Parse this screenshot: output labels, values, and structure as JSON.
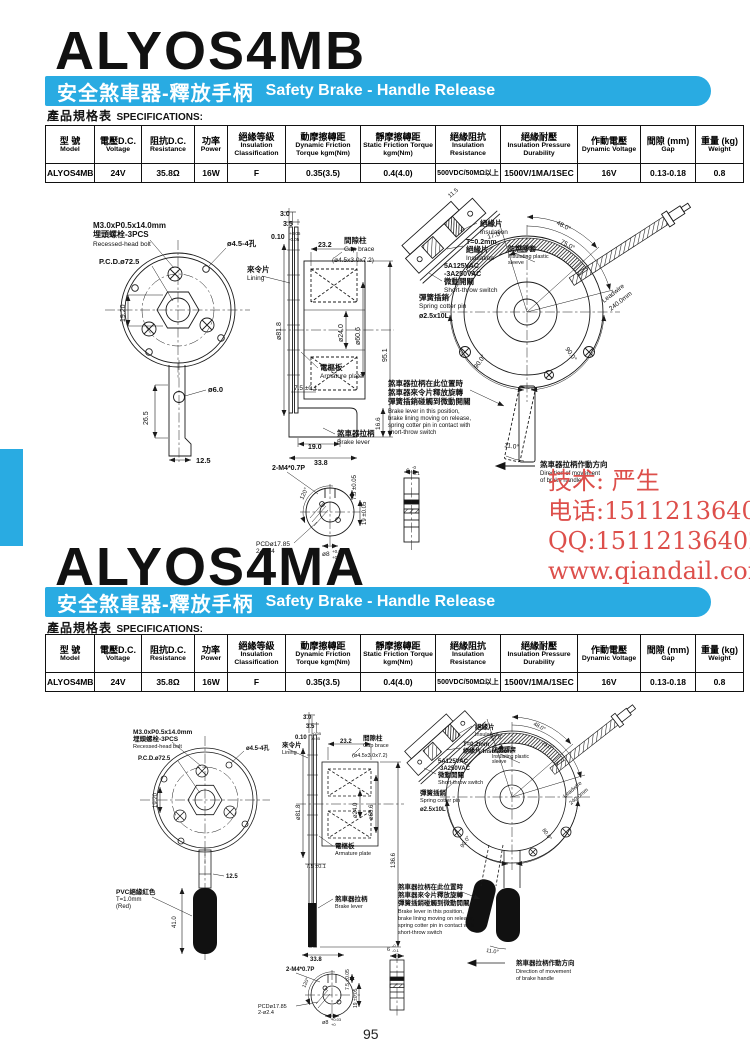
{
  "page": {
    "number": "95"
  },
  "colors": {
    "banner": "#29ABE2",
    "watermark": "#DD4F4B"
  },
  "section1": {
    "title": "ALYOS4MB"
  },
  "section2": {
    "title": "ALYOS4MA"
  },
  "banner": {
    "zh": "安全煞車器-釋放手柄",
    "en": "Safety Brake - Handle Release"
  },
  "spec_header": {
    "zh": "產品規格表",
    "en": "SPECIFICATIONS:"
  },
  "spec_table": {
    "headers": [
      {
        "zh": "型 號",
        "en": "Model"
      },
      {
        "zh": "電壓D.C.",
        "en": "Voltage"
      },
      {
        "zh": "阻抗D.C.",
        "en": "Resistance"
      },
      {
        "zh": "功率",
        "en": "Power"
      },
      {
        "zh": "絕緣等級",
        "en": "Insulation Classification"
      },
      {
        "zh": "動摩擦轉距",
        "en": "Dynamic Friction Torque kgm(Nm)"
      },
      {
        "zh": "靜摩擦轉距",
        "en": "Static Friction Torque kgm(Nm)"
      },
      {
        "zh": "絕緣阻抗",
        "en": "Insulation Resistance"
      },
      {
        "zh": "絕緣耐壓",
        "en": "Insulation Pressure Durability"
      },
      {
        "zh": "作動電壓",
        "en": "Dynamic Voltage"
      },
      {
        "zh": "間隙 (mm)",
        "en": "Gap"
      },
      {
        "zh": "重量 (kg)",
        "en": "Weight"
      }
    ],
    "row": [
      "ALYOS4MB",
      "24V",
      "35.8Ω",
      "16W",
      "F",
      "0.35(3.5)",
      "0.4(4.0)",
      "500VDC/50MΩ以上",
      "1500V/1MA/1SEC",
      "16V",
      "0.13-0.18",
      "0.8"
    ]
  },
  "watermark": {
    "lines": [
      "技术: 严生",
      "电话:15112136402",
      "QQ:15112136402",
      "www.qiandail.com"
    ]
  },
  "drawing1": {
    "labels": [
      {
        "x": 93,
        "y": 228,
        "t": "M3.0xP0.5x14.0mm",
        "s": 8,
        "b": 1
      },
      {
        "x": 93,
        "y": 237,
        "t": "埋頭螺栓-3PCS",
        "s": 8,
        "b": 1
      },
      {
        "x": 93,
        "y": 246,
        "t": "Recessed-head bolt",
        "s": 6.5
      },
      {
        "x": 99,
        "y": 264,
        "t": "P.C.D.ø72.5",
        "s": 7.5,
        "b": 1
      },
      {
        "x": 227,
        "y": 246,
        "t": "ø4.5-4孔",
        "s": 7.5,
        "b": 1
      },
      {
        "x": 125,
        "y": 322,
        "t": "19.20",
        "s": 7,
        "r": -90
      },
      {
        "x": 208,
        "y": 392,
        "t": "ø6.0",
        "s": 7.5,
        "b": 1
      },
      {
        "x": 148,
        "y": 425,
        "t": "26.5",
        "s": 7,
        "r": -90
      },
      {
        "x": 196,
        "y": 463,
        "t": "12.5",
        "s": 7.5,
        "b": 1
      },
      {
        "x": 280,
        "y": 216,
        "t": "3.0",
        "s": 7,
        "b": 1
      },
      {
        "x": 283,
        "y": 226,
        "t": "3.5",
        "s": 7,
        "b": 1
      },
      {
        "x": 271,
        "y": 239,
        "t": "0.10",
        "s": 7,
        "b": 1
      },
      {
        "x": 289,
        "y": 235,
        "t": "+0.05",
        "s": 4.5
      },
      {
        "x": 289,
        "y": 241,
        "t": "-0.05",
        "s": 4.5
      },
      {
        "x": 318,
        "y": 247,
        "t": "23.2",
        "s": 7,
        "b": 1
      },
      {
        "x": 344,
        "y": 243,
        "t": "間隙柱",
        "s": 7.5,
        "b": 1
      },
      {
        "x": 344,
        "y": 251,
        "t": "Gap brace",
        "s": 6.5
      },
      {
        "x": 332,
        "y": 262,
        "t": "(ø4.5x3.0x7.2)",
        "s": 6.5
      },
      {
        "x": 247,
        "y": 272,
        "t": "來令片",
        "s": 7.5,
        "b": 1
      },
      {
        "x": 247,
        "y": 280,
        "t": "Lining",
        "s": 6.5
      },
      {
        "x": 281,
        "y": 340,
        "t": "ø81.8",
        "s": 7,
        "r": -90
      },
      {
        "x": 343,
        "y": 342,
        "t": "ø24.0",
        "s": 7,
        "r": -90
      },
      {
        "x": 360,
        "y": 345,
        "t": "ø60.6",
        "s": 7,
        "r": -90
      },
      {
        "x": 320,
        "y": 370,
        "t": "電樞板",
        "s": 7.5,
        "b": 1
      },
      {
        "x": 320,
        "y": 378,
        "t": "Armature plate",
        "s": 6.5
      },
      {
        "x": 294,
        "y": 390,
        "t": "7.5 ±0.1",
        "s": 6.5
      },
      {
        "x": 387,
        "y": 362,
        "t": "95.1",
        "s": 7,
        "r": -90
      },
      {
        "x": 380,
        "y": 430,
        "t": "16.6",
        "s": 6.5,
        "r": -90
      },
      {
        "x": 308,
        "y": 449,
        "t": "19.0",
        "s": 7,
        "b": 1
      },
      {
        "x": 314,
        "y": 465,
        "t": "33.8",
        "s": 7,
        "b": 1
      },
      {
        "x": 337,
        "y": 436,
        "t": "煞車器拉柄",
        "s": 7.5,
        "b": 1
      },
      {
        "x": 337,
        "y": 444,
        "t": "Brake lever",
        "s": 6.5
      },
      {
        "x": 272,
        "y": 470,
        "t": "2-M4*0.7P",
        "s": 7,
        "b": 1
      },
      {
        "x": 303,
        "y": 500,
        "t": "120°",
        "s": 6,
        "r": -65
      },
      {
        "x": 256,
        "y": 546,
        "t": "PCDø17.85",
        "s": 6.5
      },
      {
        "x": 256,
        "y": 553,
        "t": "2-ø2.4",
        "s": 6.5
      },
      {
        "x": 356,
        "y": 500,
        "t": "7.5 ±0.05",
        "s": 6,
        "r": -90
      },
      {
        "x": 366,
        "y": 525,
        "t": "19 ±0.05",
        "s": 6,
        "r": -90
      },
      {
        "x": 322,
        "y": 556,
        "t": "ø8",
        "s": 6.5
      },
      {
        "x": 332,
        "y": 553,
        "t": "+0.03",
        "s": 4.5
      },
      {
        "x": 332,
        "y": 559,
        "t": "+0",
        "s": 4.5
      },
      {
        "x": 406,
        "y": 473,
        "t": "6",
        "s": 6.5
      },
      {
        "x": 412,
        "y": 469,
        "t": "-0",
        "s": 4.5
      },
      {
        "x": 412,
        "y": 475,
        "t": "-0.1",
        "s": 4.5
      },
      {
        "x": 450,
        "y": 198,
        "t": "11.5",
        "s": 6,
        "r": -40
      },
      {
        "x": 480,
        "y": 226,
        "t": "絕緣片",
        "s": 7.5,
        "b": 1
      },
      {
        "x": 480,
        "y": 234,
        "t": "Insulation",
        "s": 6.5
      },
      {
        "x": 466,
        "y": 244,
        "t": "T=0.2mm",
        "s": 7,
        "b": 1
      },
      {
        "x": 466,
        "y": 252,
        "t": "絕緣片",
        "s": 7.5,
        "b": 1
      },
      {
        "x": 466,
        "y": 260,
        "t": "Insulation",
        "s": 6.5
      },
      {
        "x": 444,
        "y": 268,
        "t": "5A125VAC",
        "s": 7,
        "b": 1
      },
      {
        "x": 444,
        "y": 276,
        "t": "-3A250VAC",
        "s": 7,
        "b": 1
      },
      {
        "x": 444,
        "y": 284,
        "t": "微動開關",
        "s": 7.5,
        "b": 1
      },
      {
        "x": 444,
        "y": 292,
        "t": "Short-throw switch",
        "s": 6.5
      },
      {
        "x": 419,
        "y": 300,
        "t": "彈簧插銷",
        "s": 7.5,
        "b": 1
      },
      {
        "x": 419,
        "y": 308,
        "t": "Spring cotter pin",
        "s": 6.5
      },
      {
        "x": 419,
        "y": 318,
        "t": "ø2.5x10L",
        "s": 7,
        "b": 1
      },
      {
        "x": 508,
        "y": 251,
        "t": "防燃膠套",
        "s": 7,
        "b": 1
      },
      {
        "x": 508,
        "y": 258,
        "t": "Insulating plastic",
        "s": 5.5
      },
      {
        "x": 508,
        "y": 264,
        "t": "sleeve",
        "s": 5.5
      },
      {
        "x": 488,
        "y": 239,
        "t": "17.0°",
        "s": 6.5,
        "r": -15
      },
      {
        "x": 556,
        "y": 224,
        "t": "48.0°",
        "s": 6.5,
        "r": 28
      },
      {
        "x": 560,
        "y": 243,
        "t": "75.0°",
        "s": 6.5,
        "r": 28
      },
      {
        "x": 604,
        "y": 303,
        "t": "Leadwire",
        "s": 6.5,
        "r": -38
      },
      {
        "x": 611,
        "y": 311,
        "t": "240.0mm",
        "s": 6.5,
        "r": -38
      },
      {
        "x": 477,
        "y": 369,
        "t": "90.0°",
        "s": 6.5,
        "r": -55
      },
      {
        "x": 565,
        "y": 349,
        "t": "90.0°",
        "s": 6.5,
        "r": 55
      },
      {
        "x": 504,
        "y": 447,
        "t": "11.0°",
        "s": 6.5,
        "r": 8
      },
      {
        "x": 388,
        "y": 386,
        "t": "煞車器拉柄在此位置時",
        "s": 7.5,
        "b": 1
      },
      {
        "x": 388,
        "y": 395,
        "t": "煞車器來令片釋放旋轉",
        "s": 7.5,
        "b": 1
      },
      {
        "x": 388,
        "y": 404,
        "t": "彈簧插銷碰觸到微動開關",
        "s": 7.5,
        "b": 1
      },
      {
        "x": 388,
        "y": 413,
        "t": "Brake lever in this position,",
        "s": 6
      },
      {
        "x": 388,
        "y": 420,
        "t": "brake lining moving on release,",
        "s": 6
      },
      {
        "x": 388,
        "y": 427,
        "t": "spring cotter pin in contact with",
        "s": 6
      },
      {
        "x": 388,
        "y": 434,
        "t": "short-throw switch",
        "s": 6
      },
      {
        "x": 540,
        "y": 467,
        "t": "煞車器拉柄作動方向",
        "s": 7.5,
        "b": 1
      },
      {
        "x": 540,
        "y": 475,
        "t": "Direction of movement",
        "s": 6
      },
      {
        "x": 540,
        "y": 482,
        "t": "of brake handle",
        "s": 6
      }
    ]
  },
  "drawing2": {
    "labels": [
      {
        "x": 133,
        "y": 734,
        "t": "M3.0xP0.5x14.0mm",
        "s": 6.5,
        "b": 1
      },
      {
        "x": 133,
        "y": 741,
        "t": "埋頭螺栓-3PCS",
        "s": 6.5,
        "b": 1
      },
      {
        "x": 133,
        "y": 748,
        "t": "Recessed-head bolt",
        "s": 5.5
      },
      {
        "x": 138,
        "y": 760,
        "t": "P.C.D.ø72.5",
        "s": 6,
        "b": 1
      },
      {
        "x": 246,
        "y": 750,
        "t": "ø4.5-4孔",
        "s": 6,
        "b": 1
      },
      {
        "x": 157,
        "y": 808,
        "t": "19.20",
        "s": 6,
        "r": -90
      },
      {
        "x": 226,
        "y": 878,
        "t": "12.5",
        "s": 6,
        "b": 1
      },
      {
        "x": 116,
        "y": 894,
        "t": "PVC絕緣紅色",
        "s": 6.5,
        "b": 1
      },
      {
        "x": 116,
        "y": 901,
        "t": "T=1.0mm",
        "s": 6
      },
      {
        "x": 116,
        "y": 908,
        "t": "(Red)",
        "s": 6
      },
      {
        "x": 176,
        "y": 928,
        "t": "41.0",
        "s": 6,
        "r": -90
      },
      {
        "x": 303,
        "y": 719,
        "t": "3.0",
        "s": 6,
        "b": 1
      },
      {
        "x": 306,
        "y": 728,
        "t": "3.5",
        "s": 6,
        "b": 1
      },
      {
        "x": 295,
        "y": 739,
        "t": "0.10",
        "s": 6,
        "b": 1
      },
      {
        "x": 311,
        "y": 735,
        "t": "+0.05",
        "s": 4
      },
      {
        "x": 311,
        "y": 740,
        "t": "-0.05",
        "s": 4
      },
      {
        "x": 340,
        "y": 743,
        "t": "23.2",
        "s": 6,
        "b": 1
      },
      {
        "x": 363,
        "y": 740,
        "t": "間隙柱",
        "s": 6.5,
        "b": 1
      },
      {
        "x": 363,
        "y": 747,
        "t": "Gap brace",
        "s": 5.5
      },
      {
        "x": 352,
        "y": 757,
        "t": "(ø4.5x3.0x7.2)",
        "s": 5.5
      },
      {
        "x": 282,
        "y": 747,
        "t": "來令片",
        "s": 6.5,
        "b": 1
      },
      {
        "x": 282,
        "y": 754,
        "t": "Lining",
        "s": 5.5
      },
      {
        "x": 300,
        "y": 820,
        "t": "ø81.8",
        "s": 6,
        "r": -90
      },
      {
        "x": 357,
        "y": 818,
        "t": "ø24.0",
        "s": 6,
        "r": -90
      },
      {
        "x": 373,
        "y": 820,
        "t": "ø60.6",
        "s": 6,
        "r": -90
      },
      {
        "x": 335,
        "y": 848,
        "t": "電樞板",
        "s": 6.5,
        "b": 1
      },
      {
        "x": 335,
        "y": 855,
        "t": "Armature plate",
        "s": 5.5
      },
      {
        "x": 306,
        "y": 868,
        "t": "7.5 ±0.1",
        "s": 5.5
      },
      {
        "x": 395,
        "y": 868,
        "t": "136.6",
        "s": 6,
        "r": -90
      },
      {
        "x": 335,
        "y": 901,
        "t": "煞車器拉柄",
        "s": 6.5,
        "b": 1
      },
      {
        "x": 335,
        "y": 908,
        "t": "Brake lever",
        "s": 5.5
      },
      {
        "x": 310,
        "y": 961,
        "t": "33.8",
        "s": 6,
        "b": 1
      },
      {
        "x": 286,
        "y": 971,
        "t": "2-M4*0.7P",
        "s": 6,
        "b": 1
      },
      {
        "x": 305,
        "y": 988,
        "t": "120°",
        "s": 5,
        "r": -65
      },
      {
        "x": 258,
        "y": 1008,
        "t": "PCDø17.85",
        "s": 5.5
      },
      {
        "x": 258,
        "y": 1014,
        "t": "2-ø2.4",
        "s": 5.5
      },
      {
        "x": 349,
        "y": 990,
        "t": "7.5 ±0.05",
        "s": 5,
        "r": -90
      },
      {
        "x": 357,
        "y": 1008,
        "t": "19 ±0.05",
        "s": 5,
        "r": -90
      },
      {
        "x": 322,
        "y": 1024,
        "t": "ø8",
        "s": 5.5
      },
      {
        "x": 331,
        "y": 1021,
        "t": "+0.03",
        "s": 4
      },
      {
        "x": 331,
        "y": 1026,
        "t": "+0",
        "s": 4
      },
      {
        "x": 387,
        "y": 951,
        "t": "6",
        "s": 5.5
      },
      {
        "x": 392,
        "y": 947,
        "t": "-0",
        "s": 4
      },
      {
        "x": 392,
        "y": 952,
        "t": "-0.1",
        "s": 4
      },
      {
        "x": 475,
        "y": 729,
        "t": "絕緣片",
        "s": 6.5,
        "b": 1
      },
      {
        "x": 475,
        "y": 736,
        "t": "Insulation",
        "s": 5.5
      },
      {
        "x": 463,
        "y": 746,
        "t": "T=0.2mm",
        "s": 6,
        "b": 1
      },
      {
        "x": 463,
        "y": 753,
        "t": "絕緣片 Insulation",
        "s": 6,
        "b": 1
      },
      {
        "x": 438,
        "y": 763,
        "t": "5A125VAC",
        "s": 6,
        "b": 1
      },
      {
        "x": 438,
        "y": 770,
        "t": "-3A250VAC",
        "s": 6,
        "b": 1
      },
      {
        "x": 438,
        "y": 777,
        "t": "微動開關",
        "s": 6.5,
        "b": 1
      },
      {
        "x": 438,
        "y": 784,
        "t": "Short-throw switch",
        "s": 5.5
      },
      {
        "x": 420,
        "y": 795,
        "t": "彈簧插銷",
        "s": 6.5,
        "b": 1
      },
      {
        "x": 420,
        "y": 802,
        "t": "Spring cotter pin",
        "s": 5.5
      },
      {
        "x": 420,
        "y": 811,
        "t": "ø2.5x10L",
        "s": 6,
        "b": 1
      },
      {
        "x": 492,
        "y": 752,
        "t": "防燃膠套",
        "s": 6,
        "b": 1
      },
      {
        "x": 492,
        "y": 758,
        "t": "Insulating plastic",
        "s": 5
      },
      {
        "x": 492,
        "y": 763,
        "t": "sleeve",
        "s": 5
      },
      {
        "x": 491,
        "y": 741,
        "t": "17.0°",
        "s": 5.5,
        "r": -15
      },
      {
        "x": 533,
        "y": 725,
        "t": "48.0°",
        "s": 5.5,
        "r": 28
      },
      {
        "x": 541,
        "y": 744,
        "t": "75.0°",
        "s": 5.5,
        "r": 28
      },
      {
        "x": 565,
        "y": 798,
        "t": "Leadwire",
        "s": 5.5,
        "r": -40
      },
      {
        "x": 571,
        "y": 805,
        "t": "240.0mm",
        "s": 5.5,
        "r": -40
      },
      {
        "x": 463,
        "y": 848,
        "t": "90.0°",
        "s": 5.5,
        "r": -55
      },
      {
        "x": 542,
        "y": 830,
        "t": "80.0°",
        "s": 5.5,
        "r": 55
      },
      {
        "x": 486,
        "y": 952,
        "t": "11.0°",
        "s": 5.5,
        "r": 8
      },
      {
        "x": 398,
        "y": 889,
        "t": "煞車器拉柄在此位置時",
        "s": 6.5,
        "b": 1
      },
      {
        "x": 398,
        "y": 897,
        "t": "煞車器來令片釋放旋轉",
        "s": 6.5,
        "b": 1
      },
      {
        "x": 398,
        "y": 905,
        "t": "彈簧插銷碰觸到微動開關",
        "s": 6.5,
        "b": 1
      },
      {
        "x": 398,
        "y": 913,
        "t": "Brake lever in this position,",
        "s": 5.5
      },
      {
        "x": 398,
        "y": 920,
        "t": "brake lining moving on release,",
        "s": 5.5
      },
      {
        "x": 398,
        "y": 927,
        "t": "spring cotter pin in contact with",
        "s": 5.5
      },
      {
        "x": 398,
        "y": 934,
        "t": "short-throw switch",
        "s": 5.5
      },
      {
        "x": 516,
        "y": 965,
        "t": "煞車器拉柄作動方向",
        "s": 6.5,
        "b": 1
      },
      {
        "x": 516,
        "y": 973,
        "t": "Direction of movement",
        "s": 5.5
      },
      {
        "x": 516,
        "y": 980,
        "t": "of brake handle",
        "s": 5.5
      }
    ]
  }
}
